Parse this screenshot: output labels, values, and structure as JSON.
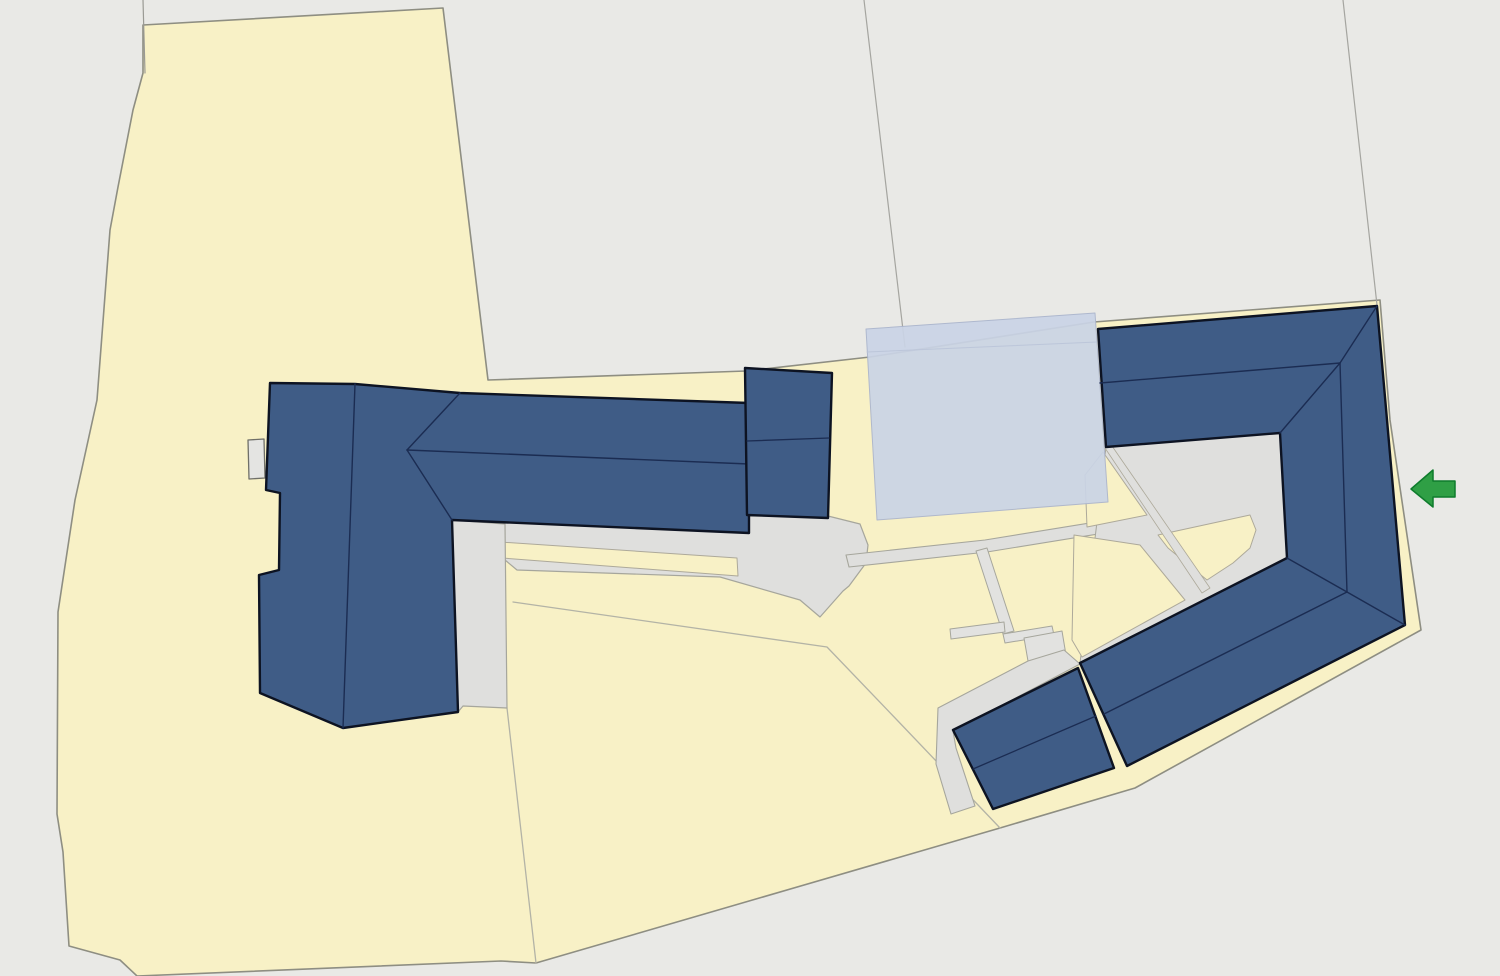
{
  "scene": {
    "width": 1500,
    "height": 976,
    "background_color": "#e9e9e6",
    "palette": {
      "parcel_yellow": "#f8f1c6",
      "parcel_stroke": "#8e8e82",
      "paving_gray": "#dfdfdd",
      "paving_stroke": "#a6a69c",
      "building_blue": "#3f5c86",
      "building_outline": "#0d1322",
      "roof_ridge_navy": "#1b2c52",
      "overlay_blue": "#cad4e6",
      "arrow_green": "#2f9f45",
      "boundary_line_gray": "#a5a5a0"
    },
    "layers": [
      {
        "name": "land-parcel",
        "kind": "polygon",
        "points": "143,25 443,8 488,380 746,371 870,357 1094,322 1380,300 1390,420 1421,630 1135,788 1000,828 536,963 501,961 137,976 120,960 69,946 63,852 57,814 58,612 75,500 97,400 110,230 118,187 133,110 143,73",
        "fill": "#f8f1c6",
        "stroke": "#8e8e82",
        "sw": 1.6
      },
      {
        "name": "boundary-line-northwest",
        "kind": "polyline",
        "points": "143,0 145,73",
        "stroke": "#9a9a94",
        "sw": 1.2
      },
      {
        "name": "boundary-line-center",
        "kind": "polyline",
        "points": "864,0 905,347",
        "stroke": "#a5a5a0",
        "sw": 1.2
      },
      {
        "name": "boundary-line-east",
        "kind": "polyline",
        "points": "1343,0 1377,305",
        "stroke": "#a5a5a0",
        "sw": 1.2
      },
      {
        "name": "parcel-subdivision-line-long",
        "kind": "polyline",
        "points": "513,602 827,647 897,720 1000,828",
        "stroke": "#b3b3a6",
        "sw": 1.3
      },
      {
        "name": "parcel-subdivision-line-south",
        "kind": "polyline",
        "points": "507,708 536,963",
        "stroke": "#b3b3a6",
        "sw": 1.3
      },
      {
        "name": "paved-yard-central",
        "kind": "polygon",
        "points": "452,520 749,531 749,516 828,516 860,524 868,545 866,563 849,586 843,591 820,617 800,600 720,577 517,570 505,560 452,535",
        "fill": "#dfdfdd",
        "stroke": "#a6a69c",
        "sw": 1.2
      },
      {
        "name": "yard-lawn-strip",
        "kind": "polygon",
        "points": "500,542 737,558 738,576 502,558",
        "fill": "#f8f1c6",
        "stroke": "#ada99a",
        "sw": 1
      },
      {
        "name": "paved-strip-southeast",
        "kind": "polygon",
        "points": "452,520 505,524 507,708 463,706 458,712",
        "fill": "#dfdfdd",
        "stroke": "#a6a69c",
        "sw": 1.2
      },
      {
        "name": "access-road",
        "kind": "polygon",
        "points": "846,555 985,540 1256,496 1258,508 987,552 849,567",
        "fill": "#dfdfdd",
        "stroke": "#a6a69c",
        "sw": 1.1
      },
      {
        "name": "courtyard-paving",
        "kind": "polygon",
        "points": "1106,447 1280,433 1287,558 1080,663",
        "fill": "#dfdfdd",
        "stroke": "#a6a69c",
        "sw": 1
      },
      {
        "name": "courtyard-lawn-northwest",
        "kind": "polygon",
        "points": "1085,475 1103,452 1147,515 1087,527",
        "fill": "#f8f1c6",
        "stroke": "#ada99a",
        "sw": 1
      },
      {
        "name": "courtyard-lawn-center",
        "kind": "polygon",
        "points": "1158,535 1250,515 1256,530 1250,548 1233,563 1207,580 1168,548",
        "fill": "#f8f1c6",
        "stroke": "#ada99a",
        "sw": 1
      },
      {
        "name": "courtyard-lawn-southwest",
        "kind": "polygon",
        "points": "1072,640 1074,535 1140,545 1185,600 1082,657",
        "fill": "#f8f1c6",
        "stroke": "#ada99a",
        "sw": 1
      },
      {
        "name": "courtyard-path-diagonal",
        "kind": "polygon",
        "points": "1105,448 1112,446 1210,588 1202,593",
        "fill": "#dfdfdd",
        "stroke": "#ada99a",
        "sw": 0.8
      },
      {
        "name": "path-north-south",
        "kind": "polygon",
        "points": "976,551 987,548 1014,631 1003,634",
        "fill": "#e2e2e0",
        "stroke": "#a6a69c",
        "sw": 1
      },
      {
        "name": "path-spur-west",
        "kind": "polygon",
        "points": "950,629 1004,622 1005,632 951,639",
        "fill": "#e2e2e0",
        "stroke": "#a6a69c",
        "sw": 1
      },
      {
        "name": "path-east-west",
        "kind": "polygon",
        "points": "1003,634 1052,626 1054,635 1005,643",
        "fill": "#e2e2e0",
        "stroke": "#a6a69c",
        "sw": 1
      },
      {
        "name": "path-landing",
        "kind": "polygon",
        "points": "1024,638 1062,631 1066,655 1028,661",
        "fill": "#e2e2e0",
        "stroke": "#a6a69c",
        "sw": 1
      },
      {
        "name": "paved-band-southwest",
        "kind": "polygon",
        "points": "938,708 1028,661 1064,650 1080,664 953,731 956,748 975,806 951,814 936,764",
        "fill": "#dfdfdd",
        "stroke": "#a6a69c",
        "sw": 1.1
      },
      {
        "name": "annex-building-west",
        "kind": "polygon",
        "points": "248,440 264,439 265,478 249,479",
        "fill": "#e4e4e2",
        "stroke": "#6f6f68",
        "sw": 1.3
      },
      {
        "name": "planned-building-overlay",
        "kind": "polygon",
        "points": "866,329 1095,313 1108,502 877,520",
        "fill": "#cad4e6",
        "stroke": "#aab4cc",
        "sw": 1,
        "opacity": 0.92
      },
      {
        "name": "planned-building-inner-line",
        "kind": "polyline",
        "points": "867,352 1097,342",
        "stroke": "#bac4d8",
        "sw": 1,
        "opacity": 0.9
      },
      {
        "name": "building-west-complex",
        "kind": "polygon",
        "points": "270,383 355,384 460,393 749,403 749,533 452,520 458,712 343,728 260,693 259,575 279,570 280,493 266,490",
        "fill": "#3f5c86",
        "stroke": "#0d1322",
        "sw": 2.4
      },
      {
        "name": "roof-ridge-west-north-south",
        "kind": "polyline",
        "points": "355,384 343,728",
        "stroke": "#1b2c52",
        "sw": 1.4
      },
      {
        "name": "roof-ridge-west-east-west",
        "kind": "polyline",
        "points": "407,450 749,464",
        "stroke": "#1b2c52",
        "sw": 1.4
      },
      {
        "name": "roof-hip-west-upper",
        "kind": "polyline",
        "points": "407,450 460,393",
        "stroke": "#1b2c52",
        "sw": 1.4
      },
      {
        "name": "roof-hip-west-lower",
        "kind": "polyline",
        "points": "407,450 452,520",
        "stroke": "#1b2c52",
        "sw": 1.4
      },
      {
        "name": "building-center-block",
        "kind": "polygon",
        "points": "745,368 832,373 828,518 747,515",
        "fill": "#3f5c86",
        "stroke": "#0d1322",
        "sw": 2.4
      },
      {
        "name": "roof-line-center-block",
        "kind": "polyline",
        "points": "747,441 829,438",
        "stroke": "#1b2c52",
        "sw": 1.3
      },
      {
        "name": "building-east-complex",
        "kind": "polygon",
        "points": "1098,329 1377,306 1405,625 1127,766 1080,663 1287,558 1280,433 1106,447",
        "fill": "#3f5c86",
        "stroke": "#0d1322",
        "sw": 2.4
      },
      {
        "name": "roof-ridge-east-top-wing",
        "kind": "polyline",
        "points": "1100,383 1340,363",
        "stroke": "#1b2c52",
        "sw": 1.4
      },
      {
        "name": "roof-hip-east-northeast",
        "kind": "polyline",
        "points": "1377,306 1340,363",
        "stroke": "#1b2c52",
        "sw": 1.4
      },
      {
        "name": "roof-hip-east-inner-north",
        "kind": "polyline",
        "points": "1280,433 1340,363",
        "stroke": "#1b2c52",
        "sw": 1.4
      },
      {
        "name": "roof-ridge-east-right-wing",
        "kind": "polyline",
        "points": "1340,363 1347,592",
        "stroke": "#1b2c52",
        "sw": 1.4
      },
      {
        "name": "roof-hip-east-southeast",
        "kind": "polyline",
        "points": "1405,625 1347,592",
        "stroke": "#1b2c52",
        "sw": 1.4
      },
      {
        "name": "roof-hip-east-inner-south",
        "kind": "polyline",
        "points": "1287,558 1347,592",
        "stroke": "#1b2c52",
        "sw": 1.4
      },
      {
        "name": "roof-ridge-east-bottom-wing",
        "kind": "polyline",
        "points": "1347,592 1104,714",
        "stroke": "#1b2c52",
        "sw": 1.4
      },
      {
        "name": "building-south-annex",
        "kind": "polygon",
        "points": "953,730 1078,668 1114,768 993,809",
        "fill": "#3f5c86",
        "stroke": "#0d1322",
        "sw": 2.4
      },
      {
        "name": "roof-ridge-south-annex",
        "kind": "polyline",
        "points": "973,769 1096,716",
        "stroke": "#1b2c52",
        "sw": 1.3
      },
      {
        "name": "entrance-arrow",
        "kind": "polygon",
        "points": "1411,489 1433,470 1433,481 1455,481 1455,497 1433,497 1433,507",
        "fill": "#2f9f45",
        "stroke": "#0e7c2c",
        "sw": 1.5
      }
    ]
  }
}
